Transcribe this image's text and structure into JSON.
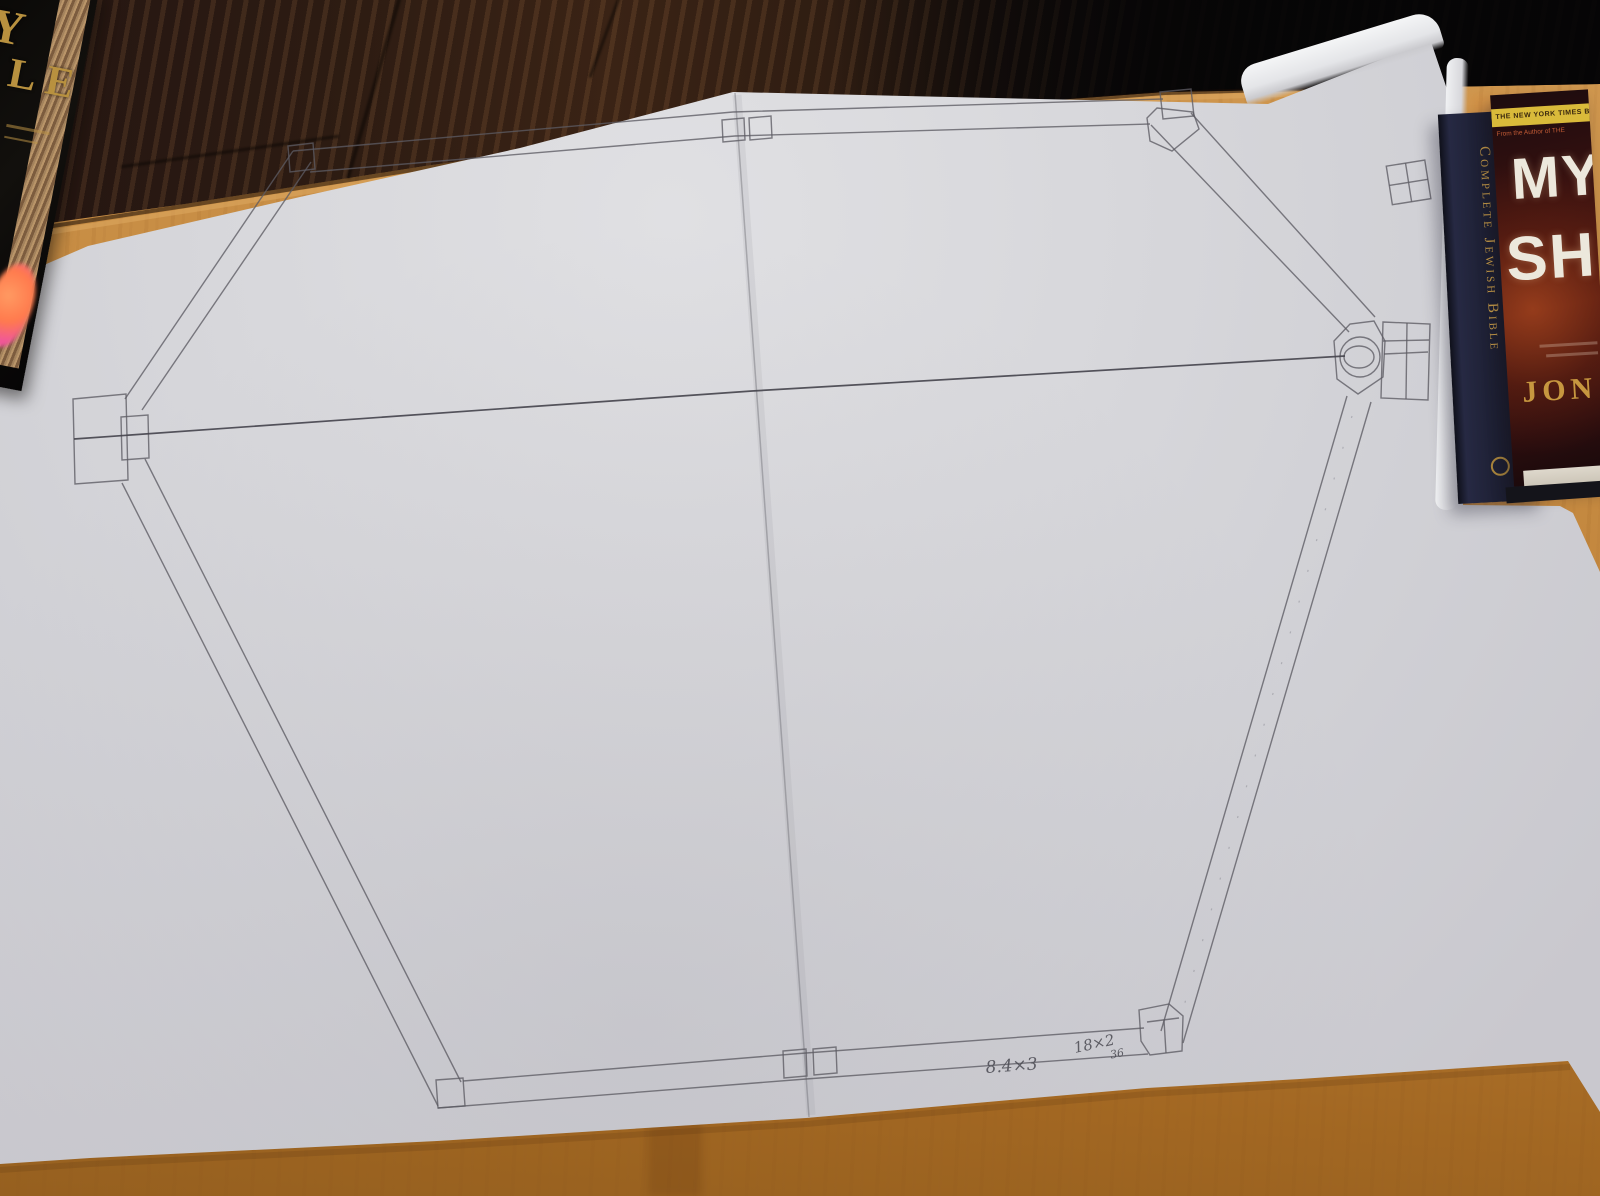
{
  "scene_type": "photo of a hand-drawn hexagonal frame plan on paper, on a wooden table with books",
  "drawing": {
    "pencil_color": "#55555c",
    "annotations": [
      {
        "text": "8.4×3"
      },
      {
        "text": "18×2",
        "sub": "36"
      }
    ]
  },
  "books": {
    "bible": {
      "letters": [
        "Y",
        "LE"
      ],
      "cover_color": "#0b0907",
      "letter_color": "#b8913f"
    },
    "jewish_bible": {
      "spine_text": "Complete Jewish Bible",
      "spine_color": "#1b1d2e",
      "text_color": "#c79b48"
    },
    "thriller": {
      "banner": "THE NEW YORK TIMES BEST",
      "subbanner": "From the Author of THE",
      "title": [
        "MY",
        "SH"
      ],
      "author": "JON",
      "banner_color": "#d9ba3a",
      "cover_color": "#571d12"
    }
  },
  "colors": {
    "table_wood": "#c3873e",
    "floor_dark": "#140e0c",
    "paper": "#d2d2d6",
    "eraser_pink": "#f0579a"
  }
}
